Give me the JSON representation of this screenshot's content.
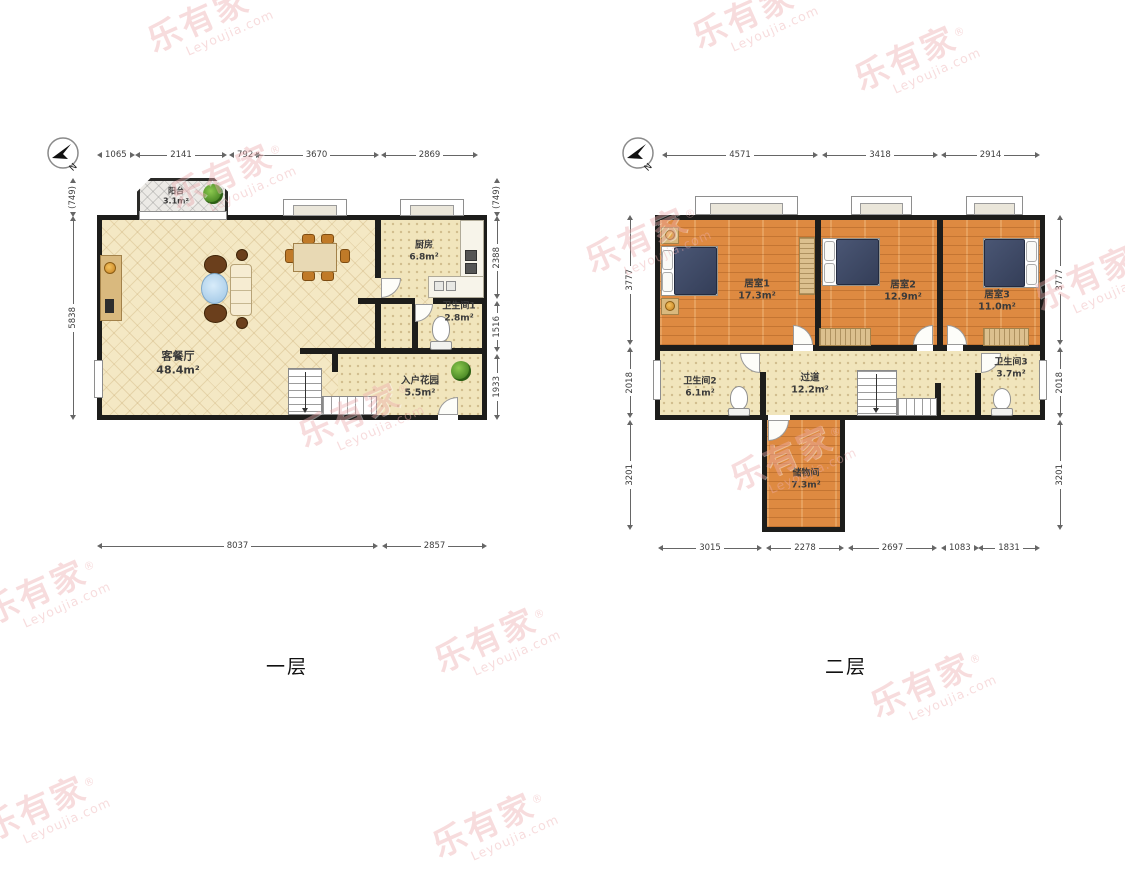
{
  "watermark": {
    "cn": "乐有家",
    "en": "Leyoujia.com",
    "reg": "®"
  },
  "compass": {
    "label": "N"
  },
  "colors": {
    "wall": "#1d1d1b",
    "wood_floor": "#de8a41",
    "tile_floor": "#f1e5bc",
    "lattice_floor": "#f4e8c4",
    "watermark_pink": "#eeaeb0"
  },
  "floors": [
    {
      "title": "一层",
      "rooms": [
        {
          "label": "阳台",
          "area": "3.1m²"
        },
        {
          "label": "客餐厅",
          "area": "48.4m²"
        },
        {
          "label": "厨房",
          "area": "6.8m²"
        },
        {
          "label": "卫生间1",
          "area": "2.8m²"
        },
        {
          "label": "入户花园",
          "area": "5.5m²"
        }
      ],
      "dims": {
        "top": [
          "1065",
          "2141",
          "792",
          "3670",
          "2869"
        ],
        "bottom": [
          "8037",
          "2857"
        ],
        "left": [
          "(749)",
          "5838"
        ],
        "right": [
          "(749)",
          "2388",
          "1516",
          "1933"
        ]
      }
    },
    {
      "title": "二层",
      "rooms": [
        {
          "label": "居室1",
          "area": "17.3m²"
        },
        {
          "label": "居室2",
          "area": "12.9m²"
        },
        {
          "label": "居室3",
          "area": "11.0m²"
        },
        {
          "label": "卫生间2",
          "area": "6.1m²"
        },
        {
          "label": "过道",
          "area": "12.2m²"
        },
        {
          "label": "卫生间3",
          "area": "3.7m²"
        },
        {
          "label": "储物间",
          "area": "7.3m²"
        }
      ],
      "dims": {
        "top": [
          "4571",
          "3418",
          "2914"
        ],
        "bottom": [
          "3015",
          "2278",
          "2697",
          "1083",
          "1831"
        ],
        "left": [
          "3777",
          "2018",
          "3201"
        ],
        "right": [
          "3777",
          "2018",
          "3201"
        ]
      }
    }
  ]
}
